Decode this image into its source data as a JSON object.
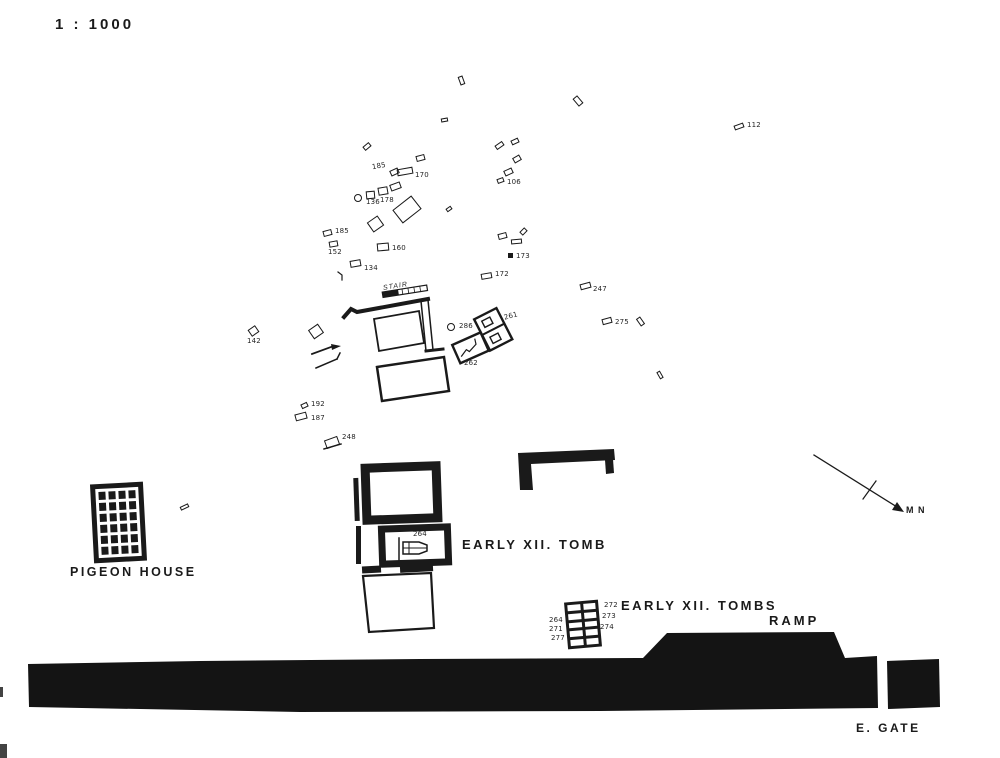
{
  "colors": {
    "ink": "#1a1a1a",
    "paper": "#ffffff"
  },
  "scale_label": "1 : 1000",
  "labels": {
    "pigeon_house": "PIGEON HOUSE",
    "early_xii_tomb": "EARLY XII. TOMB",
    "early_xii_tombs": "EARLY XII. TOMBS",
    "ramp": "RAMP",
    "e_gate": "E. GATE",
    "north": "M N",
    "stair": "STAIR"
  },
  "plan": {
    "pigeon_house_grid": {
      "rows": 6,
      "cols": 4
    },
    "grid_tomb": {
      "rows": 5,
      "cols": 2
    },
    "markers": [
      {
        "x": 459,
        "y": 76,
        "w": 5,
        "h": 9,
        "rot": -20
      },
      {
        "x": 575,
        "y": 96,
        "w": 6,
        "h": 10,
        "rot": -40
      },
      {
        "x": 441,
        "y": 118,
        "w": 7,
        "h": 4,
        "rot": -10
      },
      {
        "x": 363,
        "y": 144,
        "w": 8,
        "h": 5,
        "rot": -40
      },
      {
        "x": 416,
        "y": 155,
        "w": 9,
        "h": 6,
        "rot": -15
      },
      {
        "x": 495,
        "y": 143,
        "w": 9,
        "h": 5,
        "rot": -35
      },
      {
        "x": 511,
        "y": 139,
        "w": 8,
        "h": 5,
        "rot": -25
      },
      {
        "x": 513,
        "y": 156,
        "w": 8,
        "h": 6,
        "rot": -30
      },
      {
        "x": 504,
        "y": 169,
        "w": 9,
        "h": 6,
        "rot": -25
      },
      {
        "x": 446,
        "y": 207,
        "w": 6,
        "h": 4,
        "rot": -35
      },
      {
        "x": 638,
        "y": 317,
        "w": 5,
        "h": 9,
        "rot": -35
      },
      {
        "x": 658,
        "y": 371,
        "w": 4,
        "h": 8,
        "rot": -30
      },
      {
        "x": 180,
        "y": 505,
        "w": 9,
        "h": 4,
        "rot": -25
      },
      {
        "x": 354,
        "y": 194,
        "w": 8,
        "h": 8,
        "shape": "circle"
      },
      {
        "x": 366,
        "y": 191,
        "w": 9,
        "h": 8,
        "rot": -5
      },
      {
        "x": 378,
        "y": 187,
        "w": 10,
        "h": 8,
        "rot": -10
      },
      {
        "x": 390,
        "y": 183,
        "w": 11,
        "h": 7,
        "rot": -20
      },
      {
        "x": 395,
        "y": 201,
        "w": 24,
        "h": 17,
        "rot": -38
      },
      {
        "x": 369,
        "y": 218,
        "w": 13,
        "h": 12,
        "rot": -35
      },
      {
        "x": 310,
        "y": 326,
        "w": 12,
        "h": 11,
        "rot": -35
      },
      {
        "x": 498,
        "y": 233,
        "w": 9,
        "h": 6,
        "rot": -15
      },
      {
        "x": 511,
        "y": 239,
        "w": 11,
        "h": 5,
        "rot": -5
      },
      {
        "x": 520,
        "y": 229,
        "w": 7,
        "h": 5,
        "rot": -45
      },
      {
        "x": 734,
        "y": 124,
        "w": 10,
        "h": 5,
        "rot": -20,
        "label": "112",
        "lx": 13,
        "ly": -2
      },
      {
        "x": 390,
        "y": 169,
        "w": 9,
        "h": 6,
        "rot": -25,
        "label": "185",
        "lx": -18,
        "ly": -6,
        "lrot": -10
      },
      {
        "x": 397,
        "y": 168,
        "w": 16,
        "h": 7,
        "rot": -10,
        "label": "170",
        "lx": 18,
        "ly": 4
      },
      {
        "x": 366,
        "y": 199,
        "shape": "none",
        "label": "136"
      },
      {
        "x": 380,
        "y": 197,
        "shape": "none",
        "label": "178"
      },
      {
        "x": 323,
        "y": 230,
        "w": 9,
        "h": 6,
        "rot": -15,
        "label": "185",
        "lx": 12,
        "ly": -2
      },
      {
        "x": 329,
        "y": 241,
        "w": 9,
        "h": 6,
        "rot": -10,
        "label": "152",
        "lx": -1,
        "ly": 8
      },
      {
        "x": 377,
        "y": 243,
        "w": 12,
        "h": 8,
        "rot": -5,
        "label": "160",
        "lx": 15,
        "ly": 2
      },
      {
        "x": 350,
        "y": 260,
        "w": 11,
        "h": 7,
        "rot": -10,
        "label": "134",
        "lx": 14,
        "ly": 5
      },
      {
        "x": 497,
        "y": 178,
        "w": 7,
        "h": 5,
        "rot": -20,
        "label": "106",
        "lx": 10,
        "ly": 1
      },
      {
        "x": 508,
        "y": 253,
        "w": 5,
        "h": 5,
        "shape": "filled",
        "label": "173",
        "lx": 8,
        "ly": 0
      },
      {
        "x": 481,
        "y": 273,
        "w": 11,
        "h": 6,
        "rot": -10,
        "label": "172",
        "lx": 14,
        "ly": -2
      },
      {
        "x": 580,
        "y": 283,
        "w": 11,
        "h": 6,
        "rot": -15,
        "label": "247",
        "lx": 13,
        "ly": 3
      },
      {
        "x": 602,
        "y": 318,
        "w": 10,
        "h": 6,
        "rot": -15,
        "label": "275",
        "lx": 13,
        "ly": 1
      },
      {
        "x": 249,
        "y": 327,
        "w": 9,
        "h": 8,
        "rot": -35,
        "label": "142",
        "lx": -2,
        "ly": 11
      },
      {
        "x": 301,
        "y": 403,
        "w": 7,
        "h": 5,
        "rot": -25,
        "label": "192",
        "lx": 10,
        "ly": -2
      },
      {
        "x": 295,
        "y": 413,
        "w": 12,
        "h": 7,
        "rot": -15,
        "label": "187",
        "lx": 16,
        "ly": 2
      },
      {
        "x": 325,
        "y": 438,
        "w": 14,
        "h": 9,
        "rot": -20,
        "label": "248",
        "lx": 17,
        "ly": -4
      },
      {
        "x": 447,
        "y": 323,
        "w": 8,
        "h": 8,
        "shape": "circle",
        "label": "286",
        "lx": 12,
        "ly": 0
      },
      {
        "x": 504,
        "y": 313,
        "shape": "none",
        "label": "261",
        "lrot": -15
      },
      {
        "x": 464,
        "y": 360,
        "shape": "none",
        "label": "262"
      },
      {
        "x": 413,
        "y": 531,
        "shape": "none",
        "label": "264"
      },
      {
        "x": 604,
        "y": 602,
        "shape": "none",
        "label": "272"
      },
      {
        "x": 602,
        "y": 613,
        "shape": "none",
        "label": "273"
      },
      {
        "x": 600,
        "y": 624,
        "shape": "none",
        "label": "274"
      },
      {
        "x": 549,
        "y": 617,
        "shape": "none",
        "label": "264"
      },
      {
        "x": 549,
        "y": 626,
        "shape": "none",
        "label": "271"
      },
      {
        "x": 551,
        "y": 635,
        "shape": "none",
        "label": "277"
      }
    ]
  }
}
